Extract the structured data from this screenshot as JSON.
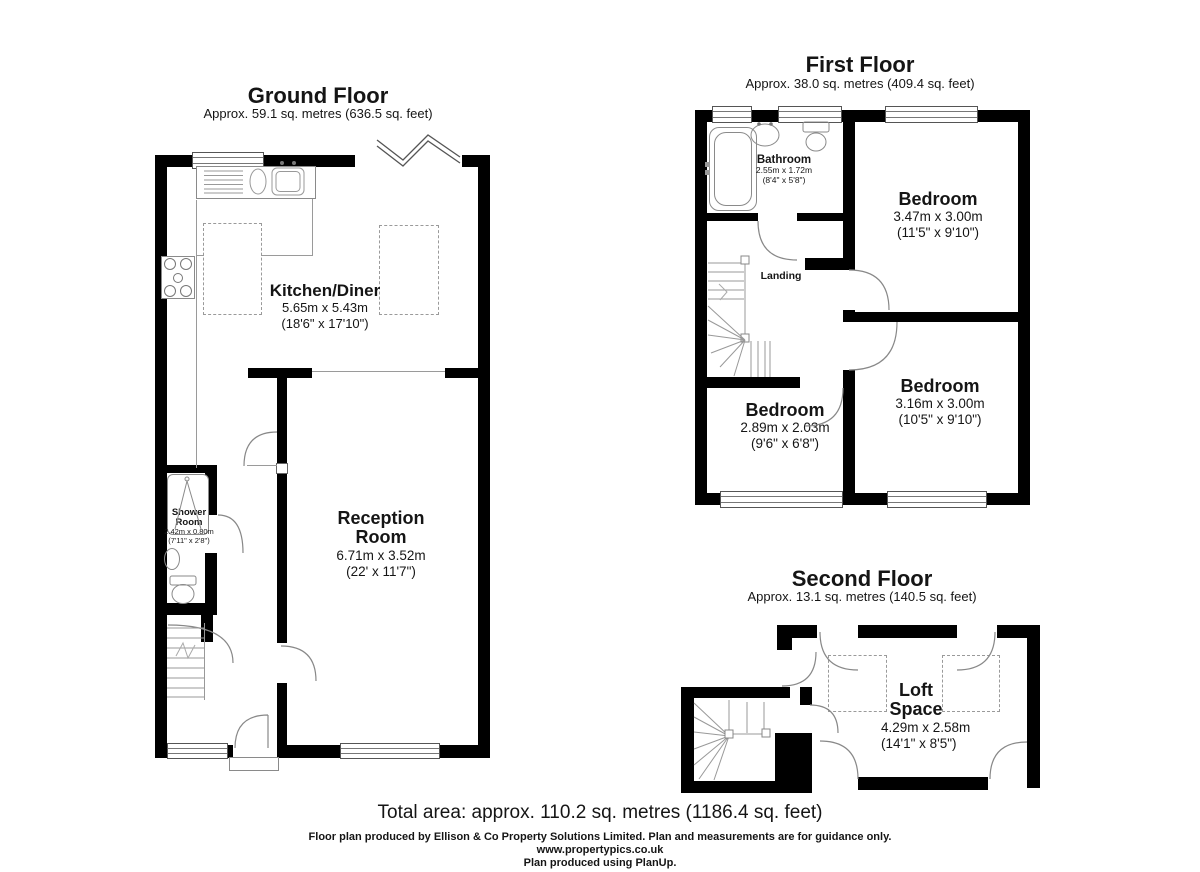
{
  "floors": [
    {
      "id": "ground",
      "title": "Ground Floor",
      "subtitle": "Approx. 59.1 sq. metres (636.5 sq. feet)",
      "rooms": [
        {
          "name": "Kitchen/Diner",
          "dims_m": "5.65m x 5.43m",
          "dims_ft": "(18'6\" x 17'10\")"
        },
        {
          "name": "Reception Room",
          "dims_m": "6.71m x 3.52m",
          "dims_ft": "(22' x 11'7\")"
        },
        {
          "name": "Shower Room",
          "dims_m": "2.42m x 0.80m",
          "dims_ft": "(7'11\" x 2'8\")"
        }
      ]
    },
    {
      "id": "first",
      "title": "First Floor",
      "subtitle": "Approx. 38.0 sq. metres (409.4 sq. feet)",
      "rooms": [
        {
          "name": "Bathroom",
          "dims_m": "2.55m x 1.72m",
          "dims_ft": "(8'4\" x 5'8\")"
        },
        {
          "name": "Bedroom",
          "dims_m": "3.47m x 3.00m",
          "dims_ft": "(11'5\" x 9'10\")"
        },
        {
          "name": "Landing"
        },
        {
          "name": "Bedroom",
          "dims_m": "2.89m x 2.03m",
          "dims_ft": "(9'6\" x 6'8\")"
        },
        {
          "name": "Bedroom",
          "dims_m": "3.16m x 3.00m",
          "dims_ft": "(10'5\" x 9'10\")"
        }
      ]
    },
    {
      "id": "second",
      "title": "Second Floor",
      "subtitle": "Approx. 13.1 sq. metres (140.5 sq. feet)",
      "rooms": [
        {
          "name": "Loft Space",
          "dims_m": "4.29m x 2.58m",
          "dims_ft": "(14'1\" x 8'5\")"
        }
      ]
    }
  ],
  "footer": {
    "total_area": "Total area: approx. 110.2 sq. metres (1186.4 sq. feet)",
    "disclaimer": "Floor plan produced by Ellison & Co Property Solutions Limited. Plan and measurements are for guidance only.",
    "website": "www.propertypics.co.uk",
    "produced_with": "Plan produced using PlanUp."
  },
  "colors": {
    "wall": "#000000",
    "fixture": "#8a8a8a",
    "dashed_furniture": "#9a9a9a",
    "text": "#151515"
  }
}
